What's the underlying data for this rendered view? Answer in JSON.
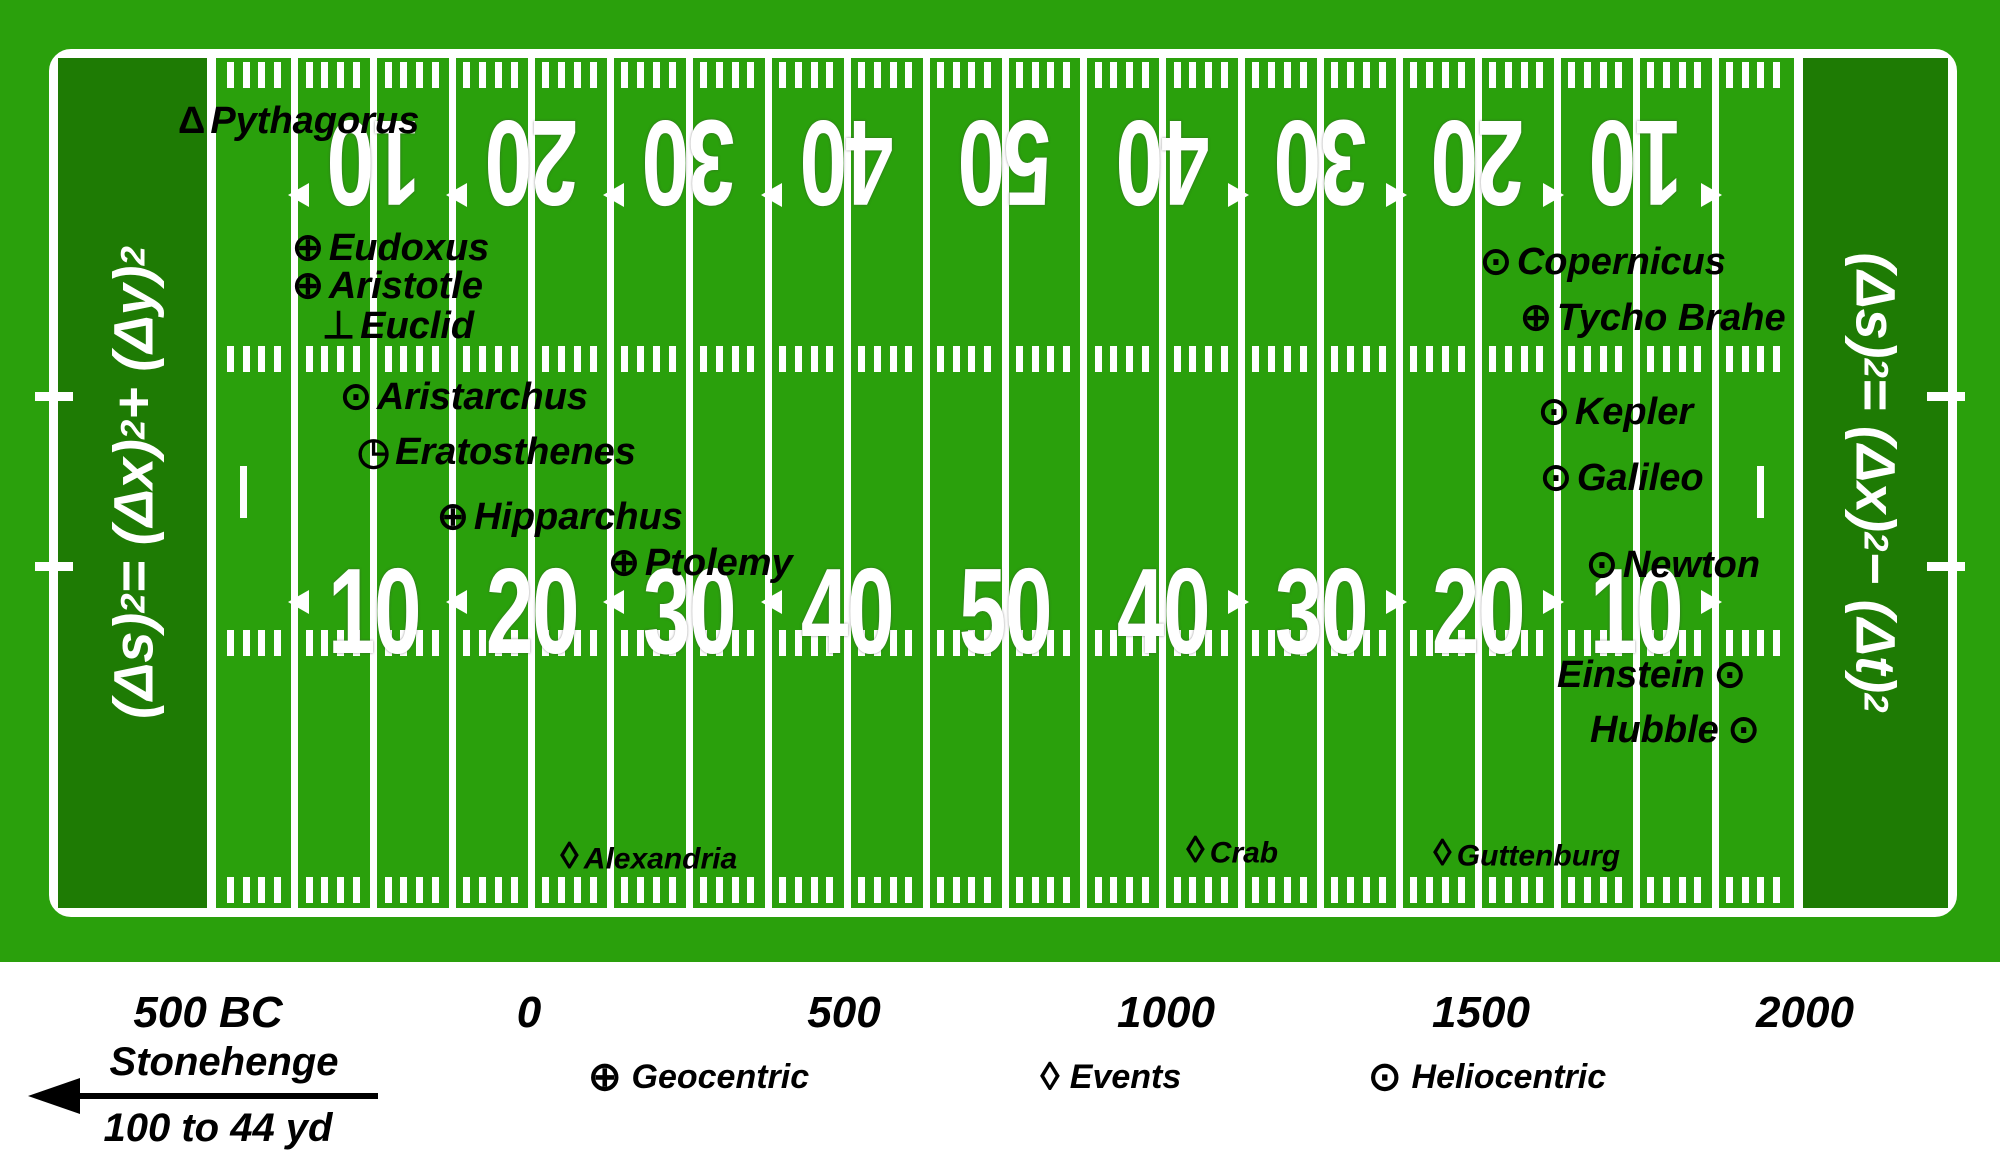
{
  "title": "History of astronomy football-field timeline",
  "colors": {
    "field_green": "#2aa00c",
    "endzone_green": "#1e7b04",
    "line_white": "#ffffff",
    "text_black": "#000000",
    "page_white": "#ffffff"
  },
  "symbols": {
    "triangle": "Δ",
    "geocentric": "⊕",
    "perpendicular": "⊥",
    "heliocentric": "⊙",
    "quadrant": "◷",
    "event": "◊"
  },
  "endzones": {
    "left_formula": [
      {
        "t": "(Δs)"
      },
      {
        "s": "2"
      },
      {
        "t": " = (Δx)"
      },
      {
        "s": "2"
      },
      {
        "t": "+ (Δy)"
      },
      {
        "s": "2"
      }
    ],
    "right_formula": [
      {
        "t": "(Δs)"
      },
      {
        "s": "2"
      },
      {
        "t": " = (Δx)"
      },
      {
        "s": "2"
      },
      {
        "t": " − (Δt)"
      },
      {
        "s": "2"
      }
    ]
  },
  "yard_numbers": {
    "top": [
      {
        "label": "10",
        "arrow": "left"
      },
      {
        "label": "20",
        "arrow": "left"
      },
      {
        "label": "30",
        "arrow": "left"
      },
      {
        "label": "40",
        "arrow": "left"
      },
      {
        "label": "50",
        "arrow": "none"
      },
      {
        "label": "40",
        "arrow": "right"
      },
      {
        "label": "30",
        "arrow": "right"
      },
      {
        "label": "20",
        "arrow": "right"
      },
      {
        "label": "10",
        "arrow": "right"
      }
    ],
    "bottom": [
      {
        "label": "10",
        "arrow": "left"
      },
      {
        "label": "20",
        "arrow": "left"
      },
      {
        "label": "30",
        "arrow": "left"
      },
      {
        "label": "40",
        "arrow": "left"
      },
      {
        "label": "50",
        "arrow": "none"
      },
      {
        "label": "40",
        "arrow": "right"
      },
      {
        "label": "30",
        "arrow": "right"
      },
      {
        "label": "20",
        "arrow": "right"
      },
      {
        "label": "10",
        "arrow": "right"
      }
    ]
  },
  "people": [
    {
      "name": "Pythagorus",
      "symbol": "triangle",
      "x": 178,
      "y": 121
    },
    {
      "name": "Eudoxus",
      "symbol": "geocentric",
      "x": 292,
      "y": 248
    },
    {
      "name": "Aristotle",
      "symbol": "geocentric",
      "x": 292,
      "y": 286
    },
    {
      "name": "Euclid",
      "symbol": "perpendicular",
      "x": 322,
      "y": 326
    },
    {
      "name": "Aristarchus",
      "symbol": "heliocentric",
      "x": 340,
      "y": 397
    },
    {
      "name": "Eratosthenes",
      "symbol": "quadrant",
      "x": 357,
      "y": 452
    },
    {
      "name": "Hipparchus",
      "symbol": "geocentric",
      "x": 437,
      "y": 517
    },
    {
      "name": "Ptolemy",
      "symbol": "geocentric",
      "x": 608,
      "y": 563
    },
    {
      "name": "Copernicus",
      "symbol": "heliocentric",
      "x": 1480,
      "y": 262
    },
    {
      "name": "Tycho Brahe",
      "symbol": "geocentric",
      "x": 1520,
      "y": 318
    },
    {
      "name": "Kepler",
      "symbol": "heliocentric",
      "x": 1538,
      "y": 412
    },
    {
      "name": "Galileo",
      "symbol": "heliocentric",
      "x": 1540,
      "y": 478
    },
    {
      "name": "Newton",
      "symbol": "heliocentric",
      "x": 1586,
      "y": 565
    },
    {
      "name": "Einstein",
      "symbol": "heliocentric",
      "x": 1557,
      "y": 675,
      "symbol_after": true
    },
    {
      "name": "Hubble",
      "symbol": "heliocentric",
      "x": 1590,
      "y": 730,
      "symbol_after": true
    }
  ],
  "events": [
    {
      "name": "Alexandria",
      "x": 560,
      "y": 858
    },
    {
      "name": "Crab",
      "x": 1186,
      "y": 852
    },
    {
      "name": "Guttenburg",
      "x": 1433,
      "y": 855
    }
  ],
  "timeline": [
    {
      "label": "500 BC",
      "cx": 208
    },
    {
      "label": "0",
      "cx": 529
    },
    {
      "label": "500",
      "cx": 844
    },
    {
      "label": "1000",
      "cx": 1166
    },
    {
      "label": "1500",
      "cx": 1481
    },
    {
      "label": "2000",
      "cx": 1805
    }
  ],
  "legend": {
    "stonehenge": {
      "title": "Stonehenge",
      "subtitle": "100 to 44 yd"
    },
    "items": [
      {
        "symbol": "⊕",
        "label": "Geocentric",
        "x": 588
      },
      {
        "symbol": "◊",
        "label": "Events",
        "x": 1040
      },
      {
        "symbol": "⊙",
        "label": "Heliocentric",
        "x": 1368
      }
    ]
  }
}
